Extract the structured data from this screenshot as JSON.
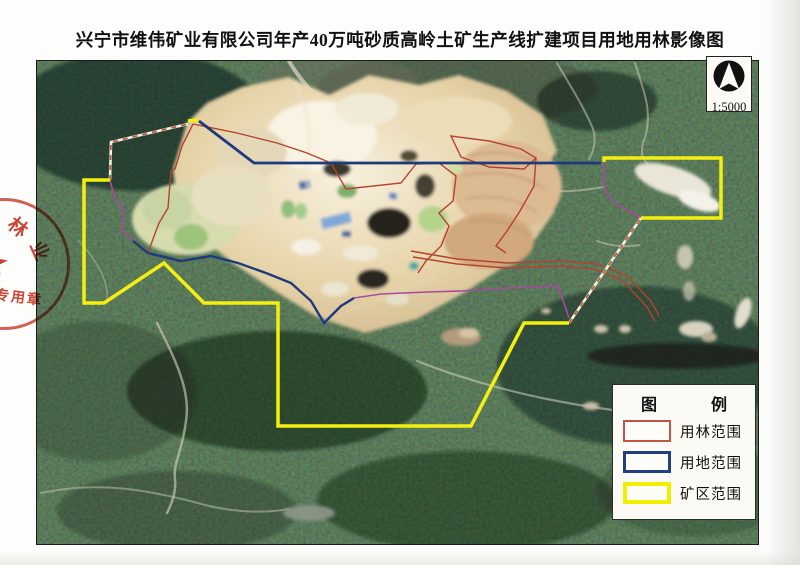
{
  "page": {
    "title": "兴宁市维伟矿业有限公司年产40万吨砂质高岭土矿生产线扩建项目用地用林影像图"
  },
  "north_indicator": {
    "icon": "north-arrow",
    "scale_label": "1:5000"
  },
  "legend": {
    "title_chars": [
      "图",
      "例"
    ],
    "items": [
      {
        "label": "用林范围",
        "color": "#c0544a",
        "style": "thin-red-outline"
      },
      {
        "label": "用地范围",
        "color": "#23407e",
        "style": "medium-blue-outline"
      },
      {
        "label": "矿区范围",
        "color": "#f2ee00",
        "style": "thick-yellow-outline"
      }
    ]
  },
  "stamp": {
    "arc_chars": [
      "林",
      "业"
    ],
    "label": "专用章",
    "color": "#c53726"
  },
  "map": {
    "type": "satellite-imagery",
    "overlays": [
      {
        "name": "forest-use-boundary",
        "color": "#b5412f"
      },
      {
        "name": "land-use-boundary",
        "color": "#1d3a7c"
      },
      {
        "name": "mining-area-boundary",
        "color": "#f2ee00"
      },
      {
        "name": "survey-line",
        "color": "#a84aa0"
      }
    ]
  }
}
